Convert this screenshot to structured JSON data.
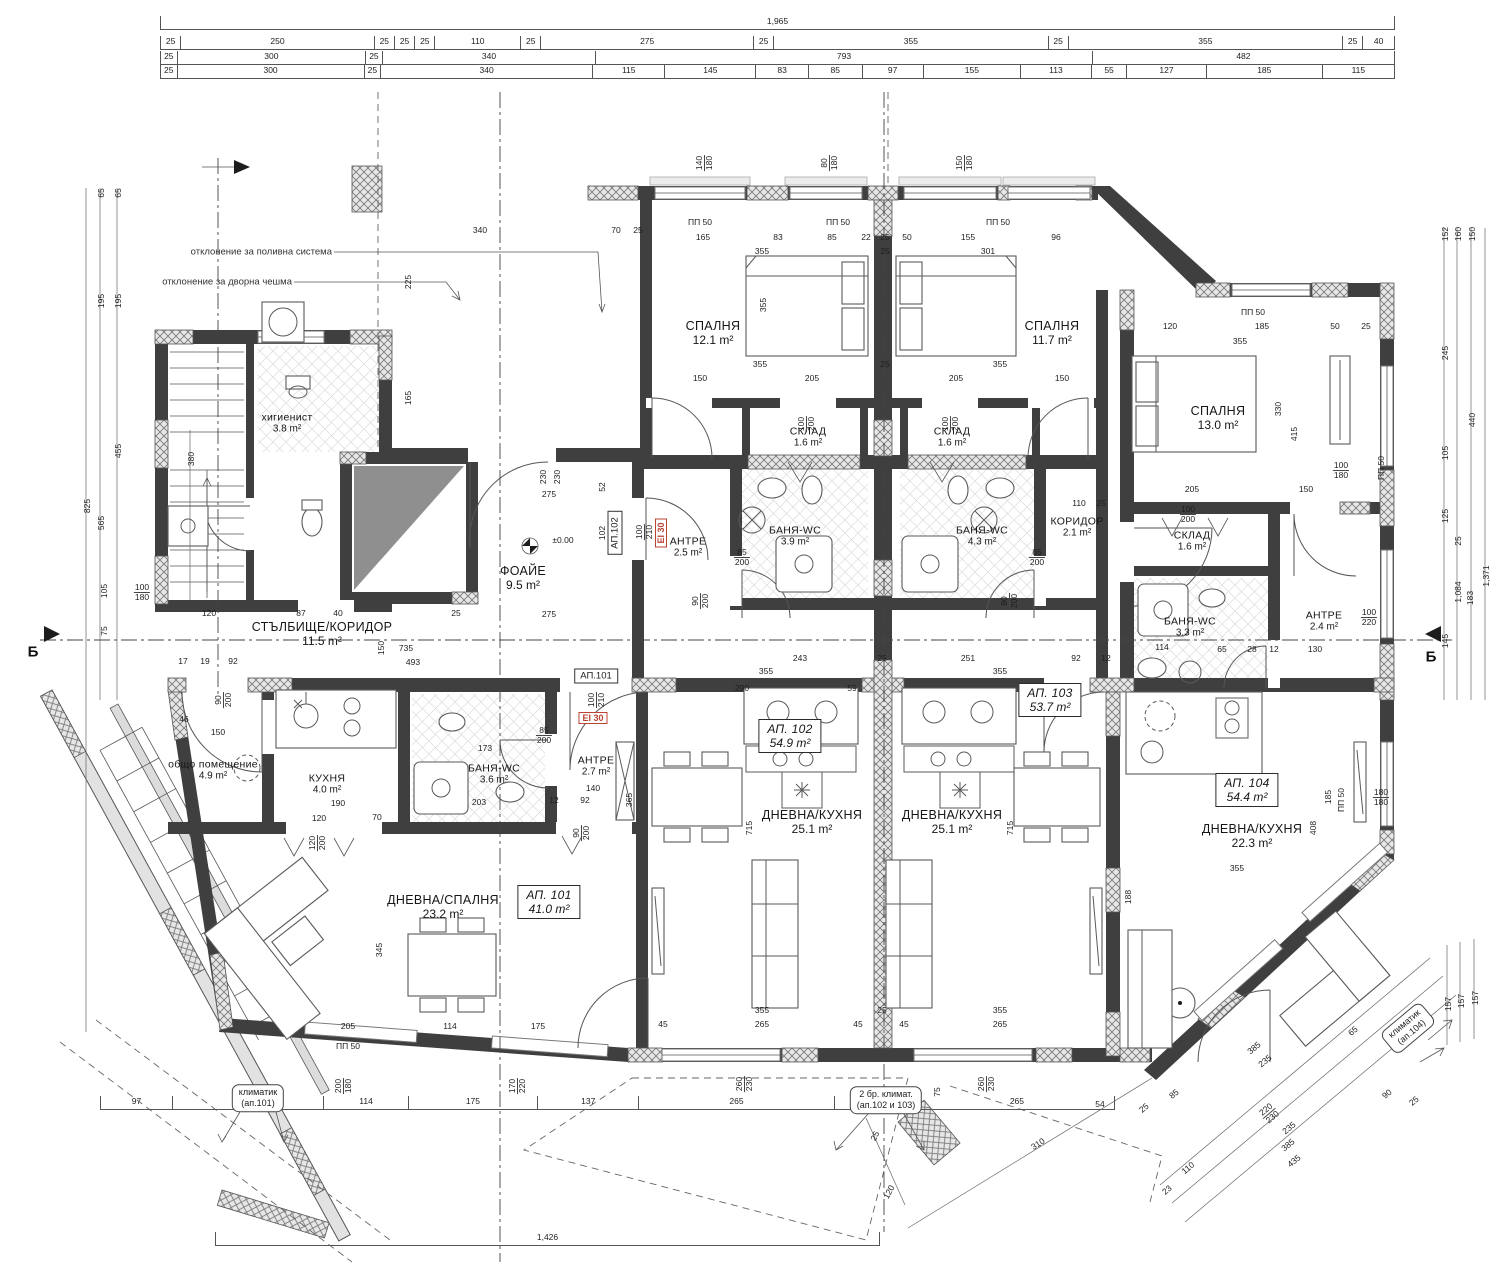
{
  "dims": {
    "top1": [
      "1,965"
    ],
    "top2": [
      "25",
      "250",
      "25",
      "25",
      "25",
      "110",
      "25",
      "275",
      "25",
      "355",
      "25",
      "355",
      "25",
      "40"
    ],
    "top3": [
      "25",
      "300",
      "25",
      "340",
      "793",
      "482"
    ],
    "top4": [
      "25",
      "300",
      "25",
      "340",
      "115",
      "145",
      "83",
      "85",
      "97",
      "155",
      "113",
      "55",
      "127",
      "185",
      "115"
    ],
    "bottom1": [
      "97",
      "205",
      "114",
      "175",
      "137",
      "265",
      "115",
      "265"
    ],
    "bottom2": [
      "1,426"
    ]
  },
  "rooms": [
    {
      "id": "higienist",
      "name": "хигиенист",
      "area": "3.8 m²",
      "x": 287,
      "y": 423,
      "cls": "sm"
    },
    {
      "id": "spalnya-1",
      "name": "СПАЛНЯ",
      "area": "12.1 m²",
      "x": 713,
      "y": 333
    },
    {
      "id": "spalnya-2",
      "name": "СПАЛНЯ",
      "area": "11.7 m²",
      "x": 1052,
      "y": 333
    },
    {
      "id": "spalnya-3",
      "name": "СПАЛНЯ",
      "area": "13.0 m²",
      "x": 1218,
      "y": 418
    },
    {
      "id": "sklad-1",
      "name": "СКЛАД",
      "area": "1.6 m²",
      "x": 808,
      "y": 437,
      "cls": "sm"
    },
    {
      "id": "sklad-2",
      "name": "СКЛАД",
      "area": "1.6 m²",
      "x": 952,
      "y": 437,
      "cls": "sm"
    },
    {
      "id": "sklad-3",
      "name": "СКЛАД",
      "area": "1.6 m²",
      "x": 1192,
      "y": 541,
      "cls": "sm"
    },
    {
      "id": "banya-1",
      "name": "БАНЯ-WC",
      "area": "3.9 m²",
      "x": 795,
      "y": 536,
      "cls": "sm"
    },
    {
      "id": "banya-2",
      "name": "БАНЯ-WC",
      "area": "4.3 m²",
      "x": 982,
      "y": 536,
      "cls": "sm"
    },
    {
      "id": "koridor",
      "name": "КОРИДОР",
      "area": "2.1 m²",
      "x": 1077,
      "y": 527,
      "cls": "sm"
    },
    {
      "id": "antre-1",
      "name": "АНТРЕ",
      "area": "2.5 m²",
      "x": 688,
      "y": 547,
      "cls": "sm"
    },
    {
      "id": "foaie",
      "name": "ФОАЙЕ",
      "area": "9.5 m²",
      "x": 523,
      "y": 578
    },
    {
      "id": "stalbishte",
      "name": "СТЪЛБИЩЕ/КОРИДОР",
      "area": "11.5 m²",
      "x": 322,
      "y": 634
    },
    {
      "id": "obshto",
      "name": "общо помещение",
      "area": "4.9 m²",
      "x": 213,
      "y": 770,
      "cls": "sm"
    },
    {
      "id": "kuhnya",
      "name": "КУХНЯ",
      "area": "4.0 m²",
      "x": 327,
      "y": 784,
      "cls": "sm"
    },
    {
      "id": "banya-3",
      "name": "БАНЯ-WC",
      "area": "3.6 m²",
      "x": 494,
      "y": 774,
      "cls": "sm"
    },
    {
      "id": "antre-2",
      "name": "АНТРЕ",
      "area": "2.7 m²",
      "x": 596,
      "y": 766,
      "cls": "sm"
    },
    {
      "id": "banya-4",
      "name": "БАНЯ-WC",
      "area": "3.3 m²",
      "x": 1190,
      "y": 627,
      "cls": "sm"
    },
    {
      "id": "antre-3",
      "name": "АНТРЕ",
      "area": "2.4 m²",
      "x": 1324,
      "y": 621,
      "cls": "sm"
    },
    {
      "id": "dnevna-spalnya",
      "name": "ДНЕВНА/СПАЛНЯ",
      "area": "23.2 m²",
      "x": 443,
      "y": 907
    },
    {
      "id": "ap101",
      "name": "АП. 101",
      "area": "41.0 m²",
      "x": 549,
      "y": 902,
      "box": true
    },
    {
      "id": "dnevna-kuhnya-1",
      "name": "ДНЕВНА/КУХНЯ",
      "area": "25.1 m²",
      "x": 812,
      "y": 822
    },
    {
      "id": "ap102",
      "name": "АП. 102",
      "area": "54.9 m²",
      "x": 790,
      "y": 736,
      "box": true
    },
    {
      "id": "dnevna-kuhnya-2",
      "name": "ДНЕВНА/КУХНЯ",
      "area": "25.1 m²",
      "x": 952,
      "y": 822
    },
    {
      "id": "ap103",
      "name": "АП. 103",
      "area": "53.7 m²",
      "x": 1050,
      "y": 700,
      "box": true
    },
    {
      "id": "dnevna-kuhnya-3",
      "name": "ДНЕВНА/КУХНЯ",
      "area": "22.3 m²",
      "x": 1252,
      "y": 836
    },
    {
      "id": "ap104",
      "name": "АП. 104",
      "area": "54.4 m²",
      "x": 1247,
      "y": 790,
      "box": true
    }
  ],
  "annotations": {
    "irrigation": "отклонение за поливна система",
    "fountain": "отклонение за дворна чешма",
    "ac101": [
      "климатик",
      "(ап.101)"
    ],
    "ac102": [
      "2 бр. климат.",
      "(ап.102 и 103)"
    ],
    "ac104": [
      "климатик",
      "(ап.104)"
    ],
    "section_letter": "Б"
  },
  "door_tags": {
    "ap101": "АП.101",
    "ap102": "АП.102",
    "fire": "EI 30"
  },
  "inline_dims": [
    {
      "t": "340",
      "x": 480,
      "y": 230
    },
    {
      "t": "70",
      "x": 616,
      "y": 230
    },
    {
      "t": "25",
      "x": 638,
      "y": 230
    },
    {
      "t": "ПП 50",
      "x": 700,
      "y": 222
    },
    {
      "t": "ПП 50",
      "x": 838,
      "y": 222
    },
    {
      "t": "ПП 50",
      "x": 998,
      "y": 222
    },
    {
      "t": "165",
      "x": 703,
      "y": 237
    },
    {
      "t": "83",
      "x": 778,
      "y": 237
    },
    {
      "t": "85",
      "x": 832,
      "y": 237
    },
    {
      "t": "22",
      "x": 866,
      "y": 237
    },
    {
      "t": "25",
      "x": 885,
      "y": 237
    },
    {
      "t": "50",
      "x": 907,
      "y": 237
    },
    {
      "t": "155",
      "x": 968,
      "y": 237
    },
    {
      "t": "96",
      "x": 1056,
      "y": 237
    },
    {
      "t": "355",
      "x": 762,
      "y": 251
    },
    {
      "t": "25",
      "x": 885,
      "y": 251
    },
    {
      "t": "301",
      "x": 988,
      "y": 251
    },
    {
      "t": "140/180",
      "x": 704,
      "y": 163,
      "r": -90
    },
    {
      "t": "80/180",
      "x": 829,
      "y": 163,
      "r": -90
    },
    {
      "t": "150/180",
      "x": 964,
      "y": 163,
      "r": -90
    },
    {
      "t": "225",
      "x": 408,
      "y": 282,
      "r": -90
    },
    {
      "t": "165",
      "x": 408,
      "y": 398,
      "r": -90
    },
    {
      "t": "355",
      "x": 763,
      "y": 305,
      "r": -90
    },
    {
      "t": "ПП 50",
      "x": 1253,
      "y": 312
    },
    {
      "t": "120",
      "x": 1170,
      "y": 326
    },
    {
      "t": "185",
      "x": 1262,
      "y": 326
    },
    {
      "t": "50",
      "x": 1335,
      "y": 326
    },
    {
      "t": "25",
      "x": 1366,
      "y": 326
    },
    {
      "t": "355",
      "x": 1240,
      "y": 341
    },
    {
      "t": "355",
      "x": 760,
      "y": 364
    },
    {
      "t": "25",
      "x": 885,
      "y": 364
    },
    {
      "t": "355",
      "x": 1000,
      "y": 364
    },
    {
      "t": "150",
      "x": 700,
      "y": 378
    },
    {
      "t": "205",
      "x": 812,
      "y": 378
    },
    {
      "t": "205",
      "x": 956,
      "y": 378
    },
    {
      "t": "150",
      "x": 1062,
      "y": 378
    },
    {
      "t": "100/200",
      "x": 806,
      "y": 424,
      "r": -90
    },
    {
      "t": "100/200",
      "x": 950,
      "y": 424,
      "r": -90
    },
    {
      "t": "205",
      "x": 1192,
      "y": 489
    },
    {
      "t": "150",
      "x": 1306,
      "y": 489
    },
    {
      "t": "330",
      "x": 1278,
      "y": 409,
      "r": -90
    },
    {
      "t": "415",
      "x": 1294,
      "y": 434,
      "r": -90
    },
    {
      "t": "100/180",
      "x": 1341,
      "y": 470
    },
    {
      "t": "ПП 50",
      "x": 1381,
      "y": 468,
      "r": -90
    },
    {
      "t": "100/200",
      "x": 1188,
      "y": 514
    },
    {
      "t": "85/200",
      "x": 742,
      "y": 557
    },
    {
      "t": "85/200",
      "x": 1037,
      "y": 557
    },
    {
      "t": "90/200",
      "x": 700,
      "y": 601,
      "r": -90
    },
    {
      "t": "90/200",
      "x": 1009,
      "y": 601,
      "r": -90
    },
    {
      "t": "110",
      "x": 1079,
      "y": 503
    },
    {
      "t": "25",
      "x": 1101,
      "y": 503
    },
    {
      "t": "100/220",
      "x": 1369,
      "y": 617
    },
    {
      "t": "130",
      "x": 1315,
      "y": 649
    },
    {
      "t": "114",
      "x": 1162,
      "y": 647
    },
    {
      "t": "65",
      "x": 1222,
      "y": 649
    },
    {
      "t": "28",
      "x": 1252,
      "y": 649
    },
    {
      "t": "12",
      "x": 1274,
      "y": 649
    },
    {
      "t": "230",
      "x": 543,
      "y": 477,
      "r": -90
    },
    {
      "t": "230",
      "x": 557,
      "y": 477,
      "r": -90
    },
    {
      "t": "275",
      "x": 549,
      "y": 494
    },
    {
      "t": "275",
      "x": 549,
      "y": 614
    },
    {
      "t": "52",
      "x": 602,
      "y": 487,
      "r": -90
    },
    {
      "t": "102",
      "x": 602,
      "y": 533,
      "r": -90
    },
    {
      "t": "±0.00",
      "x": 563,
      "y": 540
    },
    {
      "t": "100/210",
      "x": 644,
      "y": 532,
      "r": -90
    },
    {
      "t": "100/210",
      "x": 596,
      "y": 700,
      "r": -90
    },
    {
      "t": "735",
      "x": 406,
      "y": 648
    },
    {
      "t": "493",
      "x": 413,
      "y": 662
    },
    {
      "t": "120",
      "x": 209,
      "y": 613
    },
    {
      "t": "87",
      "x": 301,
      "y": 613
    },
    {
      "t": "40",
      "x": 338,
      "y": 613
    },
    {
      "t": "25",
      "x": 456,
      "y": 613
    },
    {
      "t": "17",
      "x": 183,
      "y": 661
    },
    {
      "t": "19",
      "x": 205,
      "y": 661
    },
    {
      "t": "92",
      "x": 233,
      "y": 661
    },
    {
      "t": "150",
      "x": 381,
      "y": 648,
      "r": -90
    },
    {
      "t": "90/200",
      "x": 223,
      "y": 700,
      "r": -90
    },
    {
      "t": "46",
      "x": 184,
      "y": 719
    },
    {
      "t": "150",
      "x": 218,
      "y": 732
    },
    {
      "t": "190",
      "x": 338,
      "y": 803
    },
    {
      "t": "120",
      "x": 319,
      "y": 818
    },
    {
      "t": "70",
      "x": 377,
      "y": 817
    },
    {
      "t": "120/200",
      "x": 317,
      "y": 843,
      "r": -90
    },
    {
      "t": "173",
      "x": 485,
      "y": 748
    },
    {
      "t": "203",
      "x": 479,
      "y": 802
    },
    {
      "t": "85/200",
      "x": 544,
      "y": 735
    },
    {
      "t": "140",
      "x": 593,
      "y": 788
    },
    {
      "t": "12",
      "x": 554,
      "y": 800
    },
    {
      "t": "92",
      "x": 585,
      "y": 800
    },
    {
      "t": "365",
      "x": 629,
      "y": 800,
      "r": -90
    },
    {
      "t": "90/200",
      "x": 581,
      "y": 833,
      "r": -90
    },
    {
      "t": "345",
      "x": 379,
      "y": 950,
      "r": -90
    },
    {
      "t": "715",
      "x": 749,
      "y": 828,
      "r": -90
    },
    {
      "t": "715",
      "x": 1010,
      "y": 828,
      "r": -90
    },
    {
      "t": "243",
      "x": 800,
      "y": 658
    },
    {
      "t": "355",
      "x": 766,
      "y": 671
    },
    {
      "t": "25",
      "x": 882,
      "y": 658
    },
    {
      "t": "251",
      "x": 968,
      "y": 658
    },
    {
      "t": "355",
      "x": 1000,
      "y": 671
    },
    {
      "t": "92",
      "x": 1076,
      "y": 658
    },
    {
      "t": "12",
      "x": 1106,
      "y": 658
    },
    {
      "t": "290",
      "x": 742,
      "y": 688
    },
    {
      "t": "59",
      "x": 852,
      "y": 688
    },
    {
      "t": "355",
      "x": 762,
      "y": 1010
    },
    {
      "t": "265",
      "x": 762,
      "y": 1024
    },
    {
      "t": "45",
      "x": 663,
      "y": 1024
    },
    {
      "t": "45",
      "x": 858,
      "y": 1024
    },
    {
      "t": "25",
      "x": 882,
      "y": 1010
    },
    {
      "t": "45",
      "x": 904,
      "y": 1024
    },
    {
      "t": "355",
      "x": 1000,
      "y": 1010
    },
    {
      "t": "265",
      "x": 1000,
      "y": 1024
    },
    {
      "t": "205",
      "x": 348,
      "y": 1026
    },
    {
      "t": "114",
      "x": 450,
      "y": 1026
    },
    {
      "t": "175",
      "x": 538,
      "y": 1026
    },
    {
      "t": "ПП 50",
      "x": 348,
      "y": 1046
    },
    {
      "t": "200/180",
      "x": 343,
      "y": 1086,
      "r": -90
    },
    {
      "t": "170/220",
      "x": 517,
      "y": 1086,
      "r": -90
    },
    {
      "t": "260/230",
      "x": 744,
      "y": 1084,
      "r": -90
    },
    {
      "t": "260/230",
      "x": 986,
      "y": 1084,
      "r": -90
    },
    {
      "t": "75",
      "x": 937,
      "y": 1092,
      "r": -90
    },
    {
      "t": "408",
      "x": 1313,
      "y": 828,
      "r": -90
    },
    {
      "t": "185",
      "x": 1328,
      "y": 797,
      "r": -90
    },
    {
      "t": "ПП 50",
      "x": 1341,
      "y": 800,
      "r": -90
    },
    {
      "t": "180/180",
      "x": 1381,
      "y": 797
    },
    {
      "t": "355",
      "x": 1237,
      "y": 868
    },
    {
      "t": "188",
      "x": 1128,
      "y": 897,
      "r": -90
    },
    {
      "t": "54",
      "x": 1100,
      "y": 1104
    },
    {
      "t": "310",
      "x": 1038,
      "y": 1144,
      "r": -33
    },
    {
      "t": "110",
      "x": 1188,
      "y": 1168,
      "r": -40
    },
    {
      "t": "23",
      "x": 1167,
      "y": 1190,
      "r": -40
    },
    {
      "t": "235",
      "x": 1289,
      "y": 1128,
      "r": -40
    },
    {
      "t": "385",
      "x": 1288,
      "y": 1145,
      "r": -40
    },
    {
      "t": "435",
      "x": 1294,
      "y": 1161,
      "r": -40
    },
    {
      "t": "385",
      "x": 1254,
      "y": 1048,
      "r": -40
    },
    {
      "t": "235",
      "x": 1265,
      "y": 1061,
      "r": -40
    },
    {
      "t": "65",
      "x": 1353,
      "y": 1031,
      "r": -40
    },
    {
      "t": "85",
      "x": 1174,
      "y": 1094,
      "r": -40
    },
    {
      "t": "25",
      "x": 1144,
      "y": 1108,
      "r": -40
    },
    {
      "t": "90",
      "x": 1387,
      "y": 1094,
      "r": -40
    },
    {
      "t": "25",
      "x": 1414,
      "y": 1101,
      "r": -40
    },
    {
      "t": "220/230",
      "x": 1269,
      "y": 1113,
      "r": -40
    },
    {
      "t": "120",
      "x": 889,
      "y": 1192,
      "r": -62
    },
    {
      "t": "25",
      "x": 875,
      "y": 1136,
      "r": -62
    },
    {
      "t": "157",
      "x": 1448,
      "y": 1004,
      "r": -90
    },
    {
      "t": "157",
      "x": 1461,
      "y": 1001,
      "r": -90
    },
    {
      "t": "157",
      "x": 1475,
      "y": 998,
      "r": -90
    },
    {
      "t": "152",
      "x": 1445,
      "y": 234,
      "r": -90
    },
    {
      "t": "160",
      "x": 1458,
      "y": 234,
      "r": -90
    },
    {
      "t": "150",
      "x": 1472,
      "y": 234,
      "r": -90
    },
    {
      "t": "245",
      "x": 1445,
      "y": 353,
      "r": -90
    },
    {
      "t": "440",
      "x": 1472,
      "y": 420,
      "r": -90
    },
    {
      "t": "105",
      "x": 1445,
      "y": 453,
      "r": -90
    },
    {
      "t": "125",
      "x": 1445,
      "y": 516,
      "r": -90
    },
    {
      "t": "25",
      "x": 1458,
      "y": 541,
      "r": -90
    },
    {
      "t": "1,084",
      "x": 1458,
      "y": 592,
      "r": -90
    },
    {
      "t": "183",
      "x": 1470,
      "y": 598,
      "r": -90
    },
    {
      "t": "1,371",
      "x": 1486,
      "y": 576,
      "r": -90
    },
    {
      "t": "145",
      "x": 1445,
      "y": 641,
      "r": -90
    },
    {
      "t": "65",
      "x": 101,
      "y": 193,
      "r": -90
    },
    {
      "t": "65",
      "x": 118,
      "y": 193,
      "r": -90
    },
    {
      "t": "195",
      "x": 101,
      "y": 301,
      "r": -90
    },
    {
      "t": "195",
      "x": 118,
      "y": 301,
      "r": -90
    },
    {
      "t": "825",
      "x": 87,
      "y": 506,
      "r": -90
    },
    {
      "t": "455",
      "x": 118,
      "y": 451,
      "r": -90
    },
    {
      "t": "565",
      "x": 101,
      "y": 523,
      "r": -90
    },
    {
      "t": "380",
      "x": 191,
      "y": 459,
      "r": -90
    },
    {
      "t": "105",
      "x": 104,
      "y": 591,
      "r": -90
    },
    {
      "t": "75",
      "x": 104,
      "y": 631,
      "r": -90
    },
    {
      "t": "100/180",
      "x": 142,
      "y": 592
    }
  ]
}
